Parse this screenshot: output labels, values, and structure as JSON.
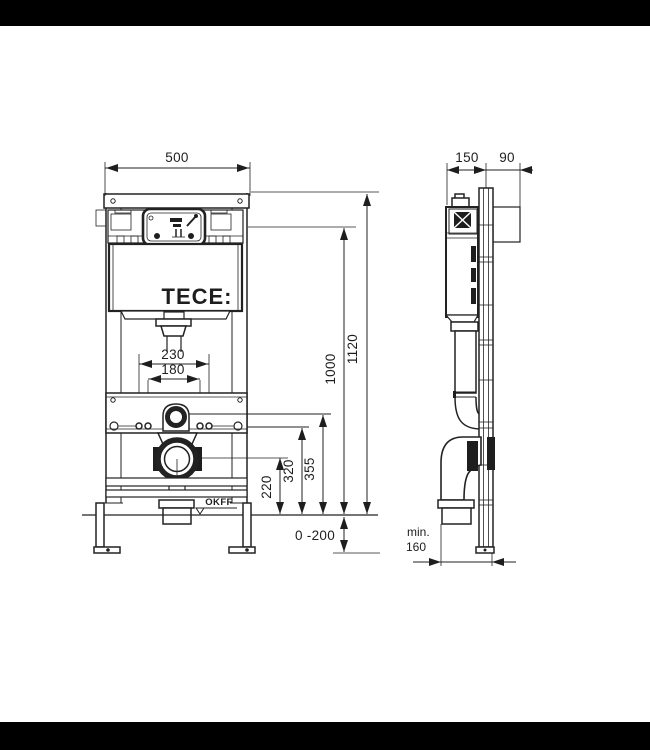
{
  "drawing": {
    "type": "technical-installation-diagram",
    "subject": "TECE concealed cistern WC mounting frame",
    "colors": {
      "background": "#ffffff",
      "lines": "#222222",
      "letterbox": "#000000"
    }
  },
  "front_view": {
    "brand_logo": "TECE:",
    "floor_reference_label": "OKFF",
    "dims": {
      "frame_width": "500",
      "drain_offset": "230",
      "anchor_spacing": "180",
      "height_to_connection": "1000",
      "total_height": "1120",
      "h_355": "355",
      "h_320": "320",
      "h_220": "220",
      "foot_adjust_range": "0 -200"
    }
  },
  "side_view": {
    "dims": {
      "frame_depth": "150",
      "top_protrusion": "90",
      "min_label": "min.",
      "min_value": "160"
    }
  }
}
